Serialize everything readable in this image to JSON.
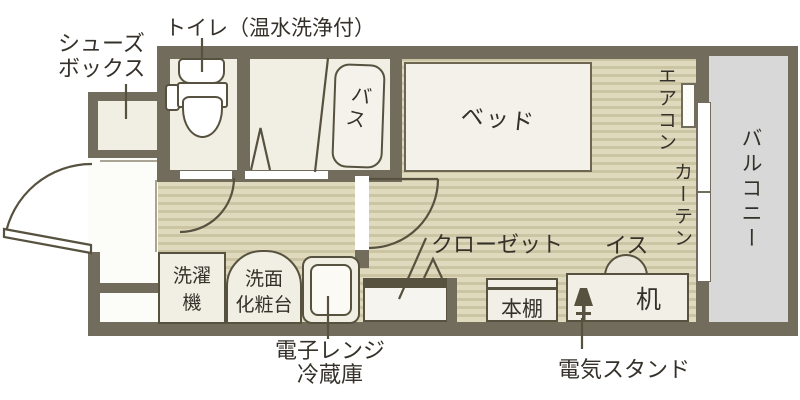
{
  "plan": {
    "title_hint": "apartment floor plan",
    "annotations": {
      "shoe_box_line1": "シューズ",
      "shoe_box_line2": "ボックス",
      "toilet": "トイレ（温水洗浄付）",
      "closet": "クローゼット",
      "chair": "イス",
      "desk_lamp": "電気スタンド",
      "microwave_line1": "電子レンジ",
      "microwave_line2": "冷蔵庫"
    },
    "rooms": {
      "bath": "バス",
      "balcony": "バルコニー"
    },
    "fixtures": {
      "bed": "ベッド",
      "aircon": "エアコン",
      "curtain": "カーテン",
      "desk": "机",
      "bookshelf": "本棚",
      "washing_line1": "洗濯",
      "washing_line2": "機",
      "vanity_line1": "洗面",
      "vanity_line2": "化粧台"
    },
    "colors": {
      "wall": "#716c5c",
      "floor_base": "#dfdabe",
      "floor_stripe": "#ccc5a4",
      "room_fill": "#f1eee3",
      "furniture_fill": "#f2efe7",
      "balcony_fill": "#d8d8d8",
      "outline": "#57523f",
      "text": "#35312a",
      "white": "#fcfcf9"
    }
  }
}
